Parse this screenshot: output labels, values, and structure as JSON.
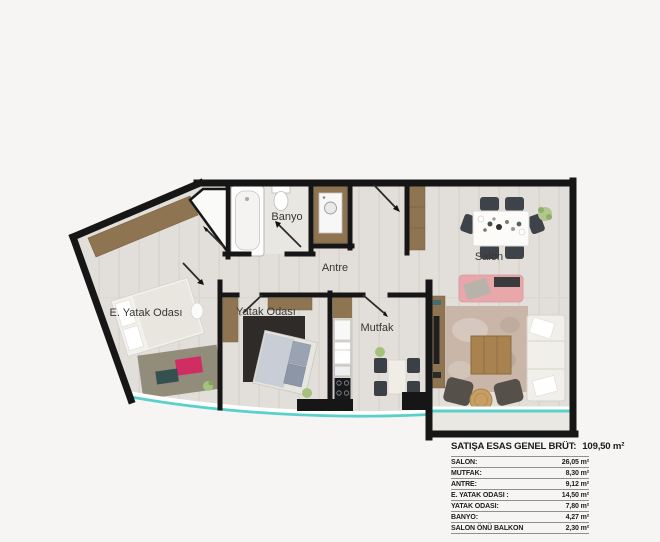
{
  "plan": {
    "labels": {
      "banyo": "Banyo",
      "antre": "Antre",
      "salon": "Salon",
      "e_yatak_odasi": "E. Yatak Odası",
      "yatak_odasi": "Yatak Odası",
      "mutfak": "Mutfak"
    },
    "colors": {
      "wall": "#161616",
      "floor": "#e2dfda",
      "wood": "#8f7452",
      "balcony_glass": "#5ad0cb",
      "sofa_pink": "#e8a7aa",
      "rug_dark": "#2e2b28"
    }
  },
  "table": {
    "title": "SATIŞA ESAS GENEL BRÜT:",
    "total": "109,50 m²",
    "rows": [
      {
        "label": "SALON:",
        "value": "26,05 m²"
      },
      {
        "label": "MUTFAK:",
        "value": "8,30 m²"
      },
      {
        "label": "ANTRE:",
        "value": "9,12 m²"
      },
      {
        "label": "E. YATAK ODASI :",
        "value": "14,50 m²"
      },
      {
        "label": "YATAK ODASI:",
        "value": "7,80 m²"
      },
      {
        "label": "BANYO:",
        "value": "4,27 m²"
      },
      {
        "label": "SALON ÖNÜ BALKON",
        "value": "2,30 m²"
      }
    ]
  }
}
